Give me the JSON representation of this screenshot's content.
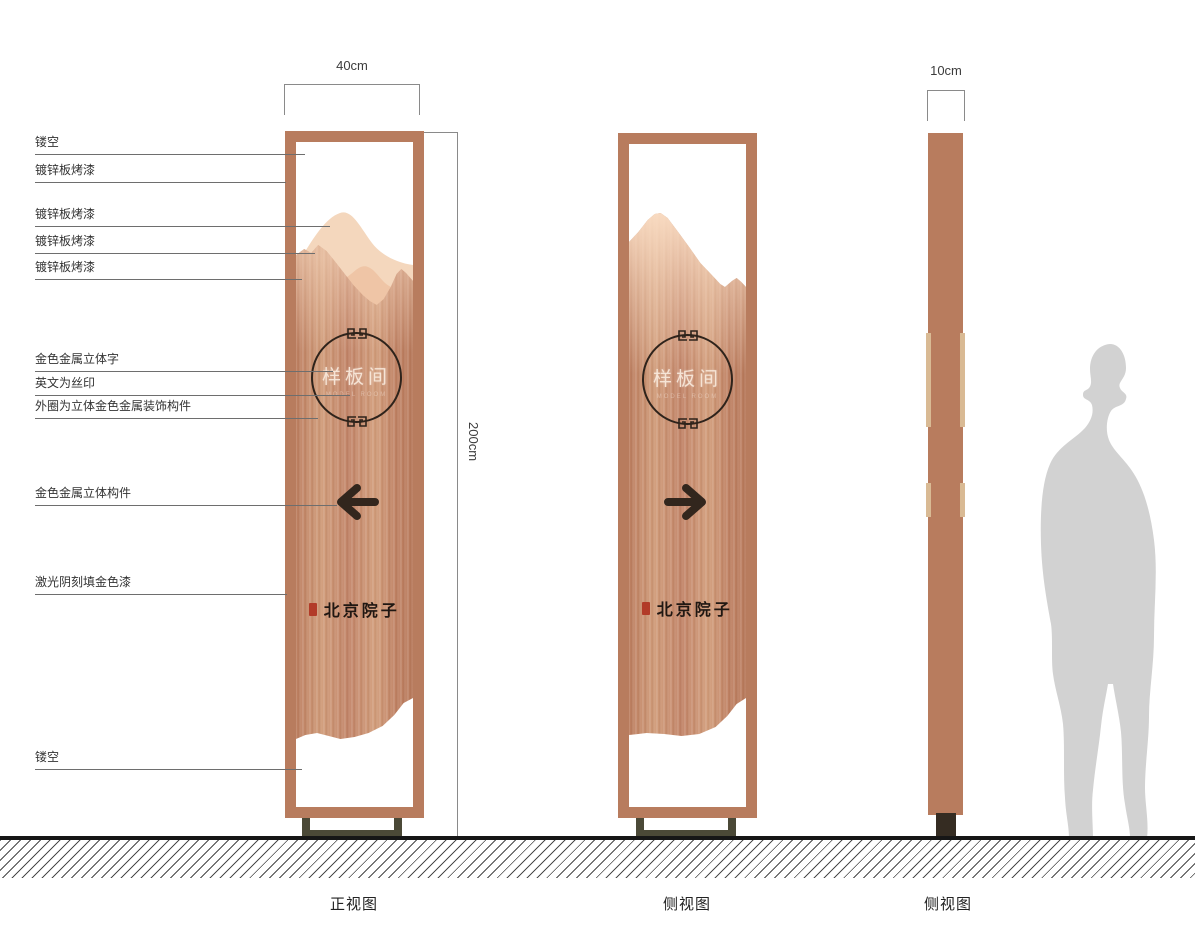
{
  "dimensions": {
    "front_width": "40cm",
    "height": "200cm",
    "side_depth": "10cm"
  },
  "annotations": {
    "items": [
      {
        "label": "镂空"
      },
      {
        "label": "镀锌板烤漆"
      },
      {
        "label": "镀锌板烤漆"
      },
      {
        "label": "镀锌板烤漆"
      },
      {
        "label": "镀锌板烤漆"
      },
      {
        "label": "金色金属立体字"
      },
      {
        "label": "英文为丝印"
      },
      {
        "label": "外圈为立体金色金属装饰构件"
      },
      {
        "label": "金色金属立体构件"
      },
      {
        "label": "激光阴刻填金色漆"
      },
      {
        "label": "镂空"
      }
    ]
  },
  "sign": {
    "circle_text": "样板间",
    "circle_subtext": "MODEL ROOM",
    "brand_text": "北京院子"
  },
  "views": {
    "front_caption": "正视图",
    "side_caption": "侧视图",
    "profile_caption": "侧视图"
  },
  "icons": {
    "front_arrow": "arrow-left-icon",
    "side_arrow": "arrow-right-icon",
    "brand_seal": "seal-stamp-icon",
    "circle_motif": "fret-scroll-icon",
    "scale_figure": "human-silhouette"
  },
  "colors": {
    "frame_copper": "#b87c5e",
    "panel_brushed_copper": "#c98e6d",
    "mountain_light": "#f4d7bd",
    "mountain_mid": "#efc5a6",
    "ink_dark": "#2e231b",
    "seal_red": "#b23b28",
    "base_olive": "#4b4937",
    "profile_strip_tan": "#d9ba94",
    "silhouette_gray": "#d2d2d2"
  }
}
